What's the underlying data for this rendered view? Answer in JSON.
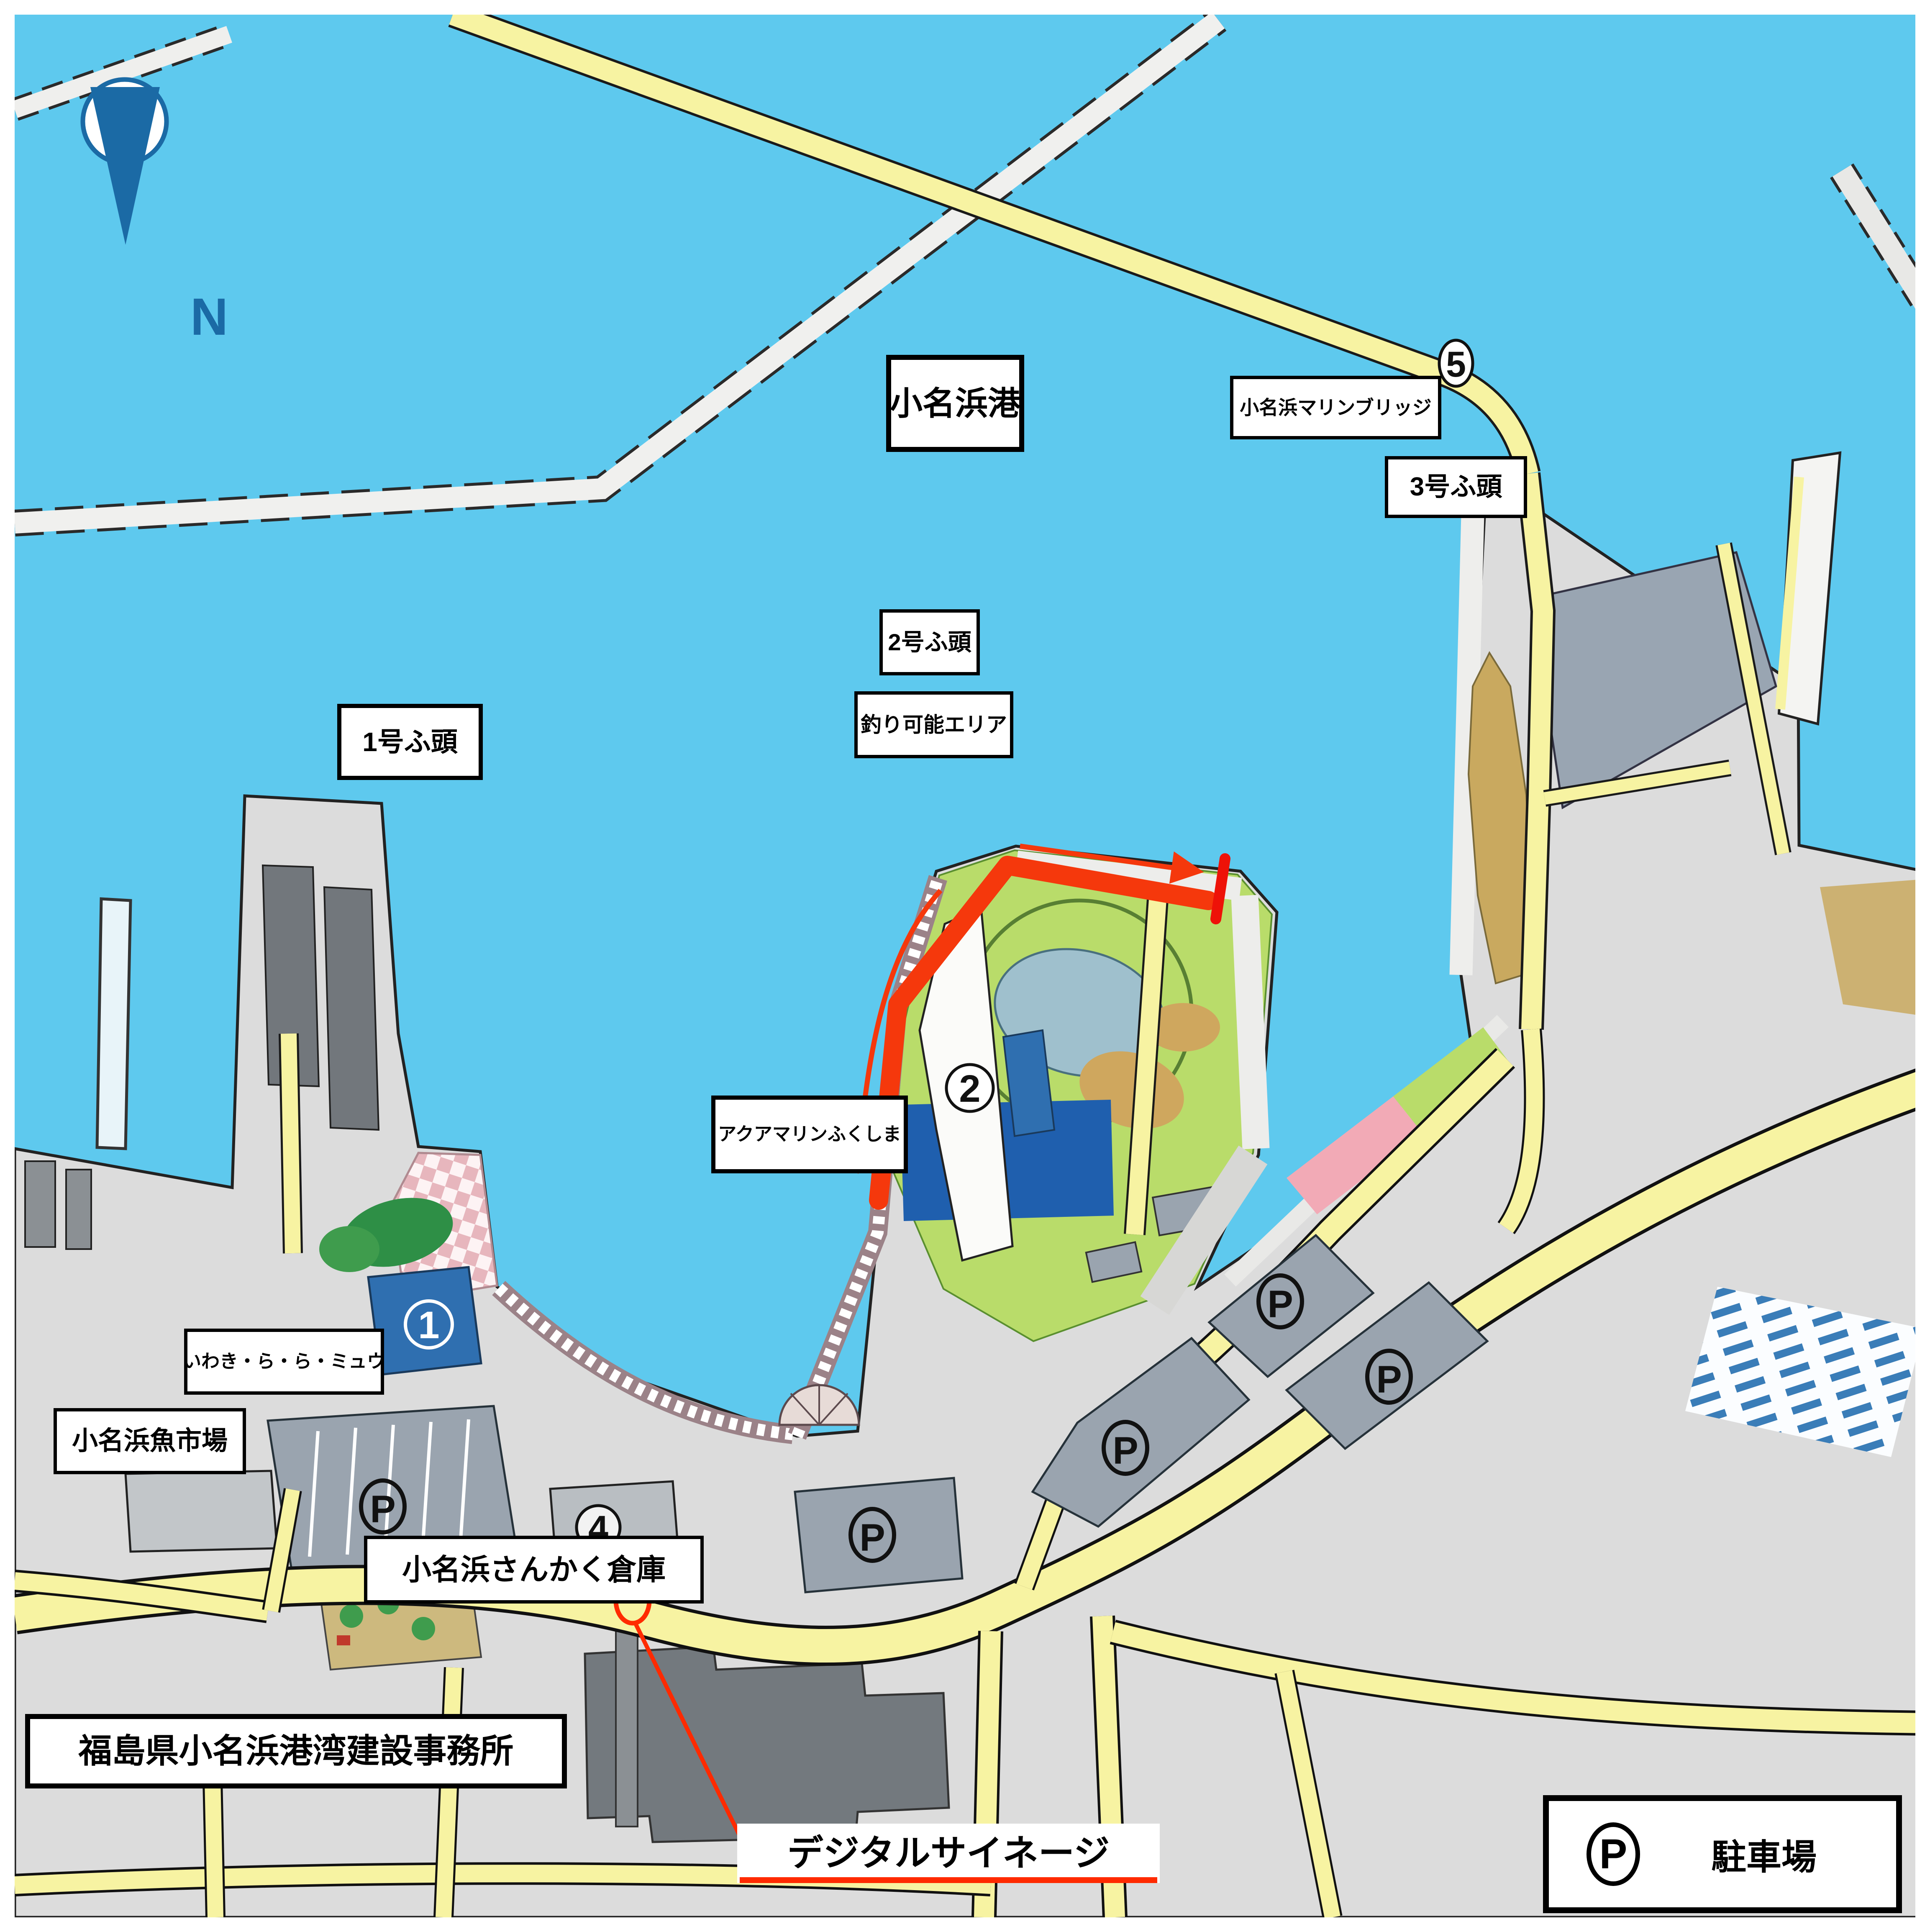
{
  "map": {
    "title": "小名浜港",
    "compass": {
      "label": "N"
    },
    "labels": {
      "marine_bridge": "小名浜マリンブリッジ",
      "pier3": "3号ふ頭",
      "pier2": "2号ふ頭",
      "fishing_area": "釣り可能エリア",
      "pier1": "1号ふ頭",
      "aquamarine": "アクアマリンふくしま",
      "lalamew": "いわき・ら・ら・ミュウ",
      "fish_market": "小名浜魚市場",
      "sankaku_warehouse": "小名浜さんかく倉庫",
      "port_construction_office": "福島県小名浜港湾建設事務所",
      "digital_signage": "デジタルサイネージ"
    },
    "numbered_points": {
      "n1": "1",
      "n2": "2",
      "n4": "4",
      "n5": "5"
    },
    "parking_symbol": "P",
    "legend": {
      "symbol": "P",
      "label": "駐車場"
    },
    "colors": {
      "sea": "#5ec9ee",
      "land": "#dcdcdc",
      "road_yellow": "#f7f3a2",
      "park_green": "#b9dc6a",
      "parking_gray": "#9aa4af",
      "building_dark": "#73797e",
      "building_blue": "#2f6fb0",
      "plaza_pink": "#e7b6bd",
      "hatch_blue": "#3a7db8",
      "fishing_highlight": "#f5380c",
      "accent_red": "#ff2a00",
      "compass_blue": "#1b6aa5"
    }
  }
}
